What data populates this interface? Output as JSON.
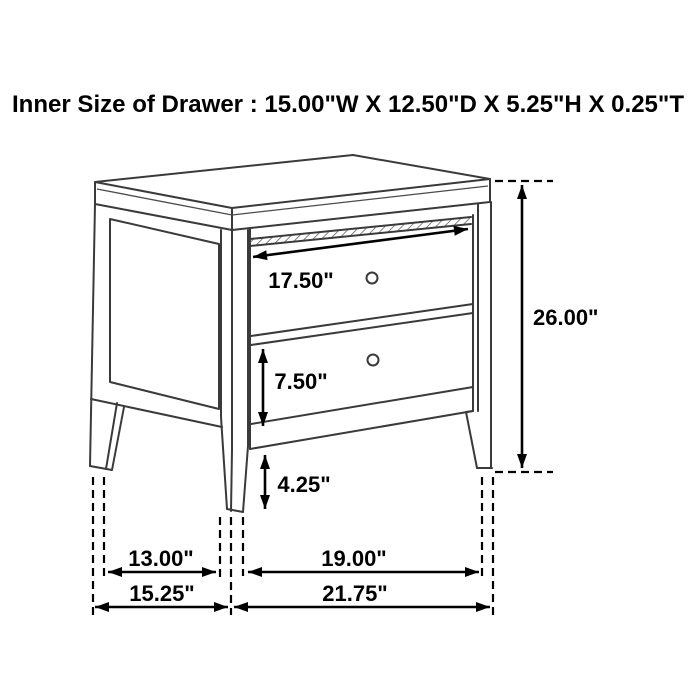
{
  "title": "Inner Size of Drawer : 15.00\"W X 12.50\"D X 5.25\"H X 0.25\"T",
  "diagram": {
    "type": "furniture-dimension-diagram",
    "subject": "two-drawer nightstand, three-quarter line drawing",
    "dims": {
      "drawer_front_width": "17.50\"",
      "overall_height": "26.00\"",
      "lower_drawer_height": "7.50\"",
      "floor_clearance": "4.25\"",
      "leg_span_depth": "13.00\"",
      "leg_span_width": "19.00\"",
      "overall_depth": "15.25\"",
      "overall_width": "21.75\""
    },
    "colors": {
      "background": "#ffffff",
      "drawing_line": "#3a3a3a",
      "dimension_line": "#000000",
      "text": "#000000"
    }
  }
}
